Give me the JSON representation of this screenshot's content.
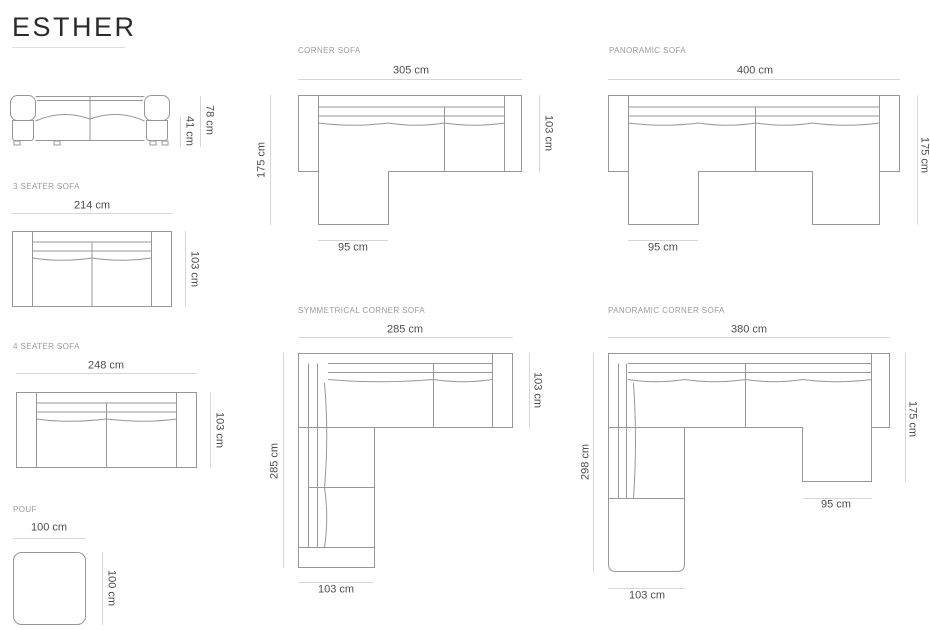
{
  "title": "ESTHER",
  "drawings": {
    "front_view": {
      "total_height": "78 cm",
      "seat_height": "41 cm"
    },
    "three_seater": {
      "label": "3 SEATER SOFA",
      "width": "214 cm",
      "depth": "103 cm"
    },
    "four_seater": {
      "label": "4 SEATER SOFA",
      "width": "248 cm",
      "depth": "103 cm"
    },
    "pouf": {
      "label": "POUF",
      "width": "100 cm",
      "depth": "100 cm"
    },
    "corner_sofa": {
      "label": "CORNER SOFA",
      "width": "305 cm",
      "depth": "103 cm",
      "total_depth": "175 cm",
      "chaise_width": "95 cm"
    },
    "panoramic_sofa": {
      "label": "PANORAMIC SOFA",
      "width": "400 cm",
      "total_depth": "175 cm",
      "chaise_width": "95 cm"
    },
    "symmetrical_corner_sofa": {
      "label": "SYMMETRICAL CORNER SOFA",
      "width": "285 cm",
      "depth": "103 cm",
      "total_depth": "285 cm",
      "corner_width": "103 cm"
    },
    "panoramic_corner_sofa": {
      "label": "PANORAMIC CORNER SOFA",
      "width": "380 cm",
      "right_depth": "175 cm",
      "left_depth": "298 cm",
      "chaise_width": "95 cm",
      "corner_width": "103 cm"
    }
  },
  "colors": {
    "background": "#ffffff",
    "title_text": "#2b2b2b",
    "label_text": "#9b9b9b",
    "dimension_text": "#4d4d4d",
    "outline": "#979797",
    "dimension_line": "#d6d6d6",
    "title_underline": "#dddddd"
  }
}
